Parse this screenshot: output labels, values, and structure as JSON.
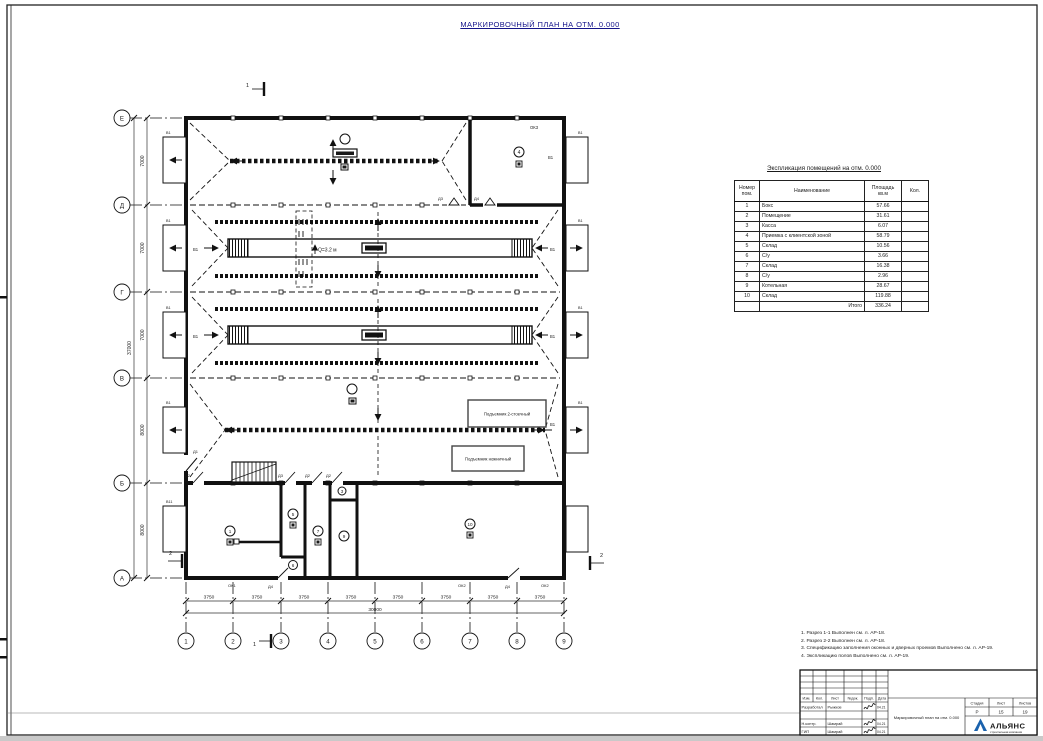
{
  "sheet": {
    "title": "МАРКИРОВОЧНЫЙ ПЛАН НА ОТМ. 0.000"
  },
  "plan": {
    "row_axes": [
      "Е",
      "Д",
      "Г",
      "В",
      "Б",
      "А"
    ],
    "col_axes": [
      "1",
      "2",
      "3",
      "4",
      "5",
      "6",
      "7",
      "8",
      "9"
    ],
    "left_dims": [
      "7000",
      "7000",
      "7000",
      "8000",
      "8000"
    ],
    "left_total": "37000",
    "bottom_dim": "3750",
    "bottom_total": "30000",
    "section_1": "1",
    "section_2": "2",
    "q_label": "Q=3.2 м",
    "lift_box_1": "Подъемник 2-стоечный",
    "lift_box_2": "Подъемник ножничный",
    "window_label": "В1",
    "window_label_2": "В11",
    "door_labels": {
      "d1": "Д1",
      "d2": "Д2",
      "d3": "Д3",
      "d4": "Д4"
    },
    "opening_labels": {
      "ok1": "ОК1",
      "ok2": "ОК2",
      "ok3": "ОК3"
    },
    "room_tags": {
      "r1": "1",
      "r3": "3",
      "r4": "4",
      "r5": "5",
      "r6": "6",
      "r7": "7",
      "r9": "9",
      "r10": "10"
    }
  },
  "explication": {
    "title": "Экспликация помещений на отм. 0.000",
    "headers": {
      "num": "Номер пом.",
      "name": "Наименование",
      "area": "Площадь кв.м",
      "qty": "Кол."
    },
    "rows": [
      {
        "num": "1",
        "name": "Бокс",
        "area": "57.66"
      },
      {
        "num": "2",
        "name": "Помещение",
        "area": "31.61"
      },
      {
        "num": "3",
        "name": "Касса",
        "area": "6.07"
      },
      {
        "num": "4",
        "name": "Приемка с клиентской зоной",
        "area": "58.79"
      },
      {
        "num": "5",
        "name": "Склад",
        "area": "10.56"
      },
      {
        "num": "6",
        "name": "С/у",
        "area": "3.66"
      },
      {
        "num": "7",
        "name": "Склад",
        "area": "16.38"
      },
      {
        "num": "8",
        "name": "С/у",
        "area": "2.96"
      },
      {
        "num": "9",
        "name": "Котельная",
        "area": "28.67"
      },
      {
        "num": "10",
        "name": "Склад",
        "area": "119.88"
      }
    ],
    "total_label": "Итого",
    "total_value": "336.24"
  },
  "notes": [
    "1. Разрез 1-1 Выполнен см. л. АР-18.",
    "2. Разрез 2-2 Выполнен см. л. АР-18.",
    "3. Спецификацию заполнения оконных и дверных проемов Выполнено см. л. АР-19.",
    "4. Экспликацию полов Выполнено см. л. АР-19."
  ],
  "title_block": {
    "rev_headers": [
      "Изм.",
      "Кол.",
      "Лист",
      "№док.",
      "Подп.",
      "Дата"
    ],
    "sig_rows": [
      {
        "role": "Разработал",
        "name": "Рыжков",
        "date": "04.21"
      },
      {
        "role": "Н.контр.",
        "name": "Шамрай",
        "date": "04.21"
      },
      {
        "role": "ГИП",
        "name": "Шамрай",
        "date": "04.21"
      }
    ],
    "stage_label": "Стадия",
    "stage_value": "Р",
    "sheet_label": "Лист",
    "sheet_value": "15",
    "sheets_label": "Листов",
    "sheets_value": "19",
    "doc_title": "Маркировочный план на отм. 0.000",
    "logo_name": "АЛЬЯНС",
    "logo_subtitle": "строительная компания",
    "logo_color": "#1a62ad"
  }
}
